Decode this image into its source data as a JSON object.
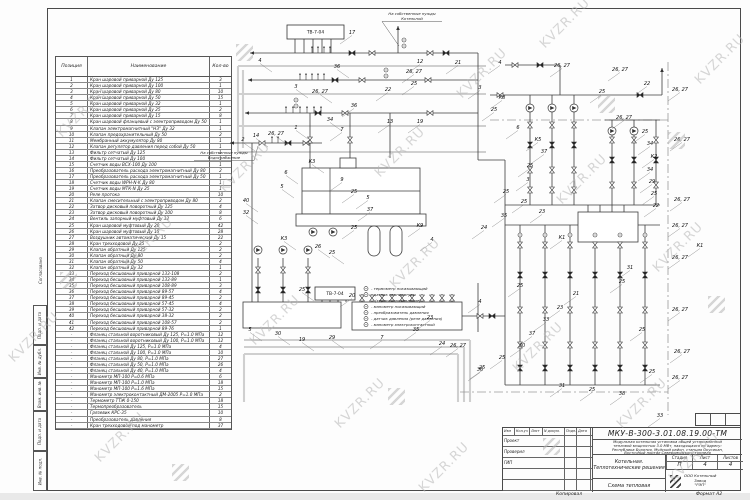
{
  "watermark": {
    "text": "KVZR.RU",
    "positions": [
      {
        "x": 50,
        "y": 105,
        "t": "text"
      },
      {
        "x": 2,
        "y": 330,
        "t": "text"
      },
      {
        "x": 116,
        "y": 235,
        "t": "text"
      },
      {
        "x": 88,
        "y": 430,
        "t": "text"
      },
      {
        "x": 213,
        "y": 160,
        "t": "text"
      },
      {
        "x": 243,
        "y": 313,
        "t": "text"
      },
      {
        "x": 368,
        "y": 145,
        "t": "text"
      },
      {
        "x": 328,
        "y": 396,
        "t": "text"
      },
      {
        "x": 450,
        "y": 66,
        "t": "text"
      },
      {
        "x": 533,
        "y": 16,
        "t": "text"
      },
      {
        "x": 550,
        "y": 172,
        "t": "text"
      },
      {
        "x": 506,
        "y": 340,
        "t": "text"
      },
      {
        "x": 646,
        "y": 240,
        "t": "text"
      },
      {
        "x": 610,
        "y": 396,
        "t": "text"
      },
      {
        "x": 688,
        "y": 52,
        "t": "text"
      },
      {
        "x": 662,
        "y": 450,
        "t": "text"
      },
      {
        "x": 412,
        "y": 460,
        "t": "text"
      },
      {
        "x": 383,
        "y": 256,
        "t": "text"
      },
      {
        "x": 236,
        "y": 44,
        "t": "logo"
      },
      {
        "x": 60,
        "y": 272,
        "t": "logo"
      },
      {
        "x": 598,
        "y": 96,
        "t": "logo"
      },
      {
        "x": 708,
        "y": 296,
        "t": "logo"
      },
      {
        "x": 543,
        "y": 438,
        "t": "logo"
      },
      {
        "x": 172,
        "y": 464,
        "t": "logo"
      },
      {
        "x": 388,
        "y": 388,
        "t": "logo"
      },
      {
        "x": 668,
        "y": 132,
        "t": "logo"
      }
    ]
  },
  "side_stamps": {
    "approval": "Согласовано",
    "cells": [
      "Подп. и дата",
      "Инв. № дубл.",
      "Взам. инв. №",
      "Подп. и дата",
      "Инв. № подл."
    ]
  },
  "spec_table": {
    "headers": {
      "position": "Позиция",
      "name": "Наименование",
      "qty": "Кол-во"
    },
    "rows": [
      [
        "1",
        "Кран шаровой приварной Ду 125",
        "3"
      ],
      [
        "2",
        "Кран шаровой приварной Ду 100",
        "1"
      ],
      [
        "3",
        "Кран шаровой приварной Ду 80",
        "10"
      ],
      [
        "4",
        "Кран шаровой приварной Ду 50",
        "15"
      ],
      [
        "5",
        "Кран шаровой приварной Ду 32",
        "1"
      ],
      [
        "6",
        "Кран шаровой приварной Ду 25",
        "2"
      ],
      [
        "7",
        "Кран шаровой приварной Ду 15",
        "8"
      ],
      [
        "8",
        "Кран шаровой фланцевый с электроприводом Ду 50",
        "1"
      ],
      [
        "9",
        "Клапан электромагнитный \"НЗ\" Ду 32",
        "1"
      ],
      [
        "10",
        "Клапан предохранительный Ду 50",
        "2"
      ],
      [
        "11",
        "Мембранный аккумулятор Ду 80",
        "1"
      ],
      [
        "12",
        "Клапан регулятор давления перед собой Ду 50",
        "1"
      ],
      [
        "13",
        "Фильтр сетчатый Ду 125",
        "1"
      ],
      [
        "14",
        "Фильтр сетчатый Ду 100",
        "1"
      ],
      [
        "15",
        "Счетчик воды ВСХ-100 Ду 100",
        "1"
      ],
      [
        "16",
        "Преобразователь расхода электромагнитный Ду 80",
        "2"
      ],
      [
        "17",
        "Преобразователь расхода электромагнитный Ду 50",
        "1"
      ],
      [
        "18",
        "Счетчик воды WPH-N-K Ду 80",
        "1"
      ],
      [
        "19",
        "Счетчик воды МТК-N Ду 25",
        "1"
      ],
      [
        "20",
        "Реле протока",
        "10"
      ],
      [
        "21",
        "Клапан смесительный с электроприводом Ду 80",
        "2"
      ],
      [
        "22",
        "Затвор дисковый поворотный Ду 125",
        "4"
      ],
      [
        "23",
        "Затвор дисковый поворотный Ду 100",
        "8"
      ],
      [
        "24",
        "Вентиль запорный муфтовый Ду 32",
        "6"
      ],
      [
        "25",
        "Кран шаровой муфтовый Ду 20",
        "42"
      ],
      [
        "26",
        "Кран шаровой муфтовый Ду 15",
        "28"
      ],
      [
        "27",
        "Воздушник автоматический Ду 15",
        "22"
      ],
      [
        "28",
        "Кран трехходовой Ду 25",
        "2"
      ],
      [
        "29",
        "Клапан обратный Ду 125",
        "2"
      ],
      [
        "30",
        "Клапан обратный Ду 80",
        "2"
      ],
      [
        "31",
        "Клапан обратный Ду 50",
        "4"
      ],
      [
        "32",
        "Клапан обратный Ду 32",
        "1"
      ],
      [
        "33",
        "Переход бесшовный приварной 133-108",
        "2"
      ],
      [
        "34",
        "Переход бесшовный приварной 133-89",
        "1"
      ],
      [
        "35",
        "Переход бесшовный приварной 108-89",
        "3"
      ],
      [
        "36",
        "Переход бесшовный приварной 89-57",
        "4"
      ],
      [
        "37",
        "Переход бесшовный приварной 89-45",
        "2"
      ],
      [
        "38",
        "Переход бесшовный приварной 57-45",
        "4"
      ],
      [
        "39",
        "Переход бесшовный приварной 57-32",
        "2"
      ],
      [
        "40",
        "Переход бесшовный приварной 38-32",
        "2"
      ],
      [
        "41",
        "Переход бесшовный приварной 108-57",
        "2"
      ],
      [
        "42",
        "Переход бесшовный приварной 89-76",
        "1"
      ],
      [
        "-",
        "Фланец стальной воротниковый Ду 125, Р=1.0 МПа",
        "12"
      ],
      [
        "-",
        "Фланец стальной воротниковый Ду 100, Р=1.0 МПа",
        "12"
      ],
      [
        "-",
        "Фланец стальной Ду 125, Р=1.0 МПа",
        "4"
      ],
      [
        "-",
        "Фланец стальной Ду 100, Р=1.0 МПа",
        "10"
      ],
      [
        "-",
        "Фланец стальной Ду 80, Р=1.0 МПа",
        "27"
      ],
      [
        "-",
        "Фланец стальной Ду 50, Р=1.0 МПа",
        "26"
      ],
      [
        "-",
        "Фланец стальной Ду 40, Р=1.0 МПа",
        "4"
      ],
      [
        "-",
        "Манометр МП-100 Р=0.6 МПа",
        "6"
      ],
      [
        "-",
        "Манометр МП-100 Р=1.0 МПа",
        "18"
      ],
      [
        "-",
        "Манометр МП-100 Р=1.6 МПа",
        "15"
      ],
      [
        "-",
        "Манометр электроконтактный ДМ-2005 Р=1.0 МПа",
        "2"
      ],
      [
        "-",
        "Термометр ТТЖ 0-150",
        "18"
      ],
      [
        "-",
        "Термопреобразователь",
        "15"
      ],
      [
        "-",
        "Грязевик КРС-35",
        "10"
      ],
      [
        "-",
        "Преобразователь давления",
        "8"
      ],
      [
        "-",
        "Кран трехходовой под манометр",
        "37"
      ]
    ]
  },
  "schematic": {
    "equipment_boxes": [
      {
        "x": 287,
        "y": 25,
        "w": 57,
        "h": 14,
        "label": "ТВ-7-04"
      },
      {
        "x": 315,
        "y": 287,
        "w": 40,
        "h": 13,
        "label": "ТВ-7-04"
      }
    ],
    "notes": [
      {
        "x": 412,
        "y": 11,
        "lines": [
          "На собственные нужды",
          "Котельной"
        ],
        "tx": 399,
        "ty": 46
      },
      {
        "x": 224,
        "y": 150,
        "lines": [
          "На собственные нужды",
          "Водоснабжение"
        ],
        "tx": 258,
        "ty": 146
      }
    ],
    "legend": {
      "x": 366,
      "y": 290,
      "items": [
        [
          "термометр показывающий",
          1
        ],
        [
          "датчик температуры",
          1
        ],
        [
          "(термосопротивление)",
          0
        ],
        [
          "манометр показывающий",
          1
        ],
        [
          "преобразователь давления",
          1
        ],
        [
          "датчик давления (реле давления)",
          1
        ],
        [
          "манометр электроконтактный",
          1
        ]
      ]
    },
    "labels": [
      [
        352,
        34,
        "17"
      ],
      [
        260,
        62,
        "4"
      ],
      [
        337,
        68,
        "36"
      ],
      [
        296,
        88,
        "3"
      ],
      [
        320,
        93,
        "26, 27"
      ],
      [
        388,
        91,
        "22"
      ],
      [
        414,
        85,
        "25"
      ],
      [
        420,
        63,
        "12"
      ],
      [
        414,
        73,
        "26, 27"
      ],
      [
        458,
        64,
        "21"
      ],
      [
        500,
        64,
        "4"
      ],
      [
        296,
        129,
        "1"
      ],
      [
        330,
        121,
        "34"
      ],
      [
        354,
        107,
        "36"
      ],
      [
        342,
        131,
        "7"
      ],
      [
        390,
        123,
        "13"
      ],
      [
        420,
        123,
        "19"
      ],
      [
        243,
        141,
        "2"
      ],
      [
        256,
        137,
        "14"
      ],
      [
        276,
        135,
        "26, 27"
      ],
      [
        312,
        163,
        "К3"
      ],
      [
        286,
        174,
        "6"
      ],
      [
        282,
        188,
        "5"
      ],
      [
        342,
        181,
        "9"
      ],
      [
        354,
        193,
        "25"
      ],
      [
        368,
        199,
        "5"
      ],
      [
        370,
        211,
        "37"
      ],
      [
        246,
        202,
        "40"
      ],
      [
        246,
        214,
        "32"
      ],
      [
        284,
        240,
        "К3"
      ],
      [
        318,
        248,
        "26"
      ],
      [
        332,
        254,
        "25"
      ],
      [
        354,
        229,
        "25"
      ],
      [
        420,
        227,
        "К9"
      ],
      [
        432,
        241,
        "4"
      ],
      [
        250,
        331,
        "5"
      ],
      [
        278,
        335,
        "30"
      ],
      [
        302,
        341,
        "19"
      ],
      [
        332,
        339,
        "29"
      ],
      [
        382,
        339,
        "7"
      ],
      [
        302,
        291,
        "25"
      ],
      [
        352,
        297,
        "20"
      ],
      [
        430,
        319,
        "23"
      ],
      [
        416,
        331,
        "35"
      ],
      [
        442,
        345,
        "24"
      ],
      [
        458,
        347,
        "26, 27"
      ],
      [
        482,
        369,
        "25"
      ],
      [
        502,
        99,
        "К8"
      ],
      [
        480,
        89,
        "3"
      ],
      [
        494,
        111,
        "25"
      ],
      [
        518,
        129,
        "6"
      ],
      [
        538,
        141,
        "К5"
      ],
      [
        544,
        153,
        "37"
      ],
      [
        530,
        167,
        "25"
      ],
      [
        528,
        181,
        "3"
      ],
      [
        562,
        67,
        "26, 27"
      ],
      [
        620,
        71,
        "26, 27"
      ],
      [
        647,
        85,
        "22"
      ],
      [
        602,
        93,
        "25"
      ],
      [
        624,
        119,
        "26, 27"
      ],
      [
        645,
        133,
        "25"
      ],
      [
        650,
        145,
        "34"
      ],
      [
        654,
        158,
        "К2"
      ],
      [
        650,
        171,
        "34"
      ],
      [
        652,
        183,
        "29"
      ],
      [
        654,
        195,
        "25"
      ],
      [
        656,
        207,
        "22"
      ],
      [
        506,
        193,
        "25"
      ],
      [
        524,
        203,
        "25"
      ],
      [
        542,
        213,
        "23"
      ],
      [
        504,
        217,
        "35"
      ],
      [
        484,
        229,
        "24"
      ],
      [
        562,
        239,
        "К1"
      ],
      [
        700,
        247,
        "К1"
      ],
      [
        680,
        91,
        "26, 27"
      ],
      [
        682,
        141,
        "26, 27"
      ],
      [
        682,
        201,
        "26, 27"
      ],
      [
        680,
        227,
        "26, 27"
      ],
      [
        680,
        259,
        "26, 27"
      ],
      [
        680,
        311,
        "26, 27"
      ],
      [
        682,
        353,
        "26, 27"
      ],
      [
        680,
        379,
        "26, 27"
      ],
      [
        630,
        269,
        "31"
      ],
      [
        622,
        283,
        "25"
      ],
      [
        576,
        295,
        "21"
      ],
      [
        560,
        309,
        "23"
      ],
      [
        546,
        321,
        "33"
      ],
      [
        532,
        335,
        "37"
      ],
      [
        642,
        331,
        "25"
      ],
      [
        652,
        373,
        "25"
      ],
      [
        622,
        395,
        "38"
      ],
      [
        592,
        391,
        "25"
      ],
      [
        562,
        387,
        "31"
      ],
      [
        522,
        347,
        "30"
      ],
      [
        502,
        359,
        "25"
      ],
      [
        480,
        303,
        "4"
      ],
      [
        520,
        287,
        "25"
      ],
      [
        480,
        371,
        "36"
      ],
      [
        660,
        417,
        "33"
      ]
    ]
  },
  "title_block": {
    "doc_number": "МКУ-В-300-3.01.08.19.00-ТМ",
    "description_lines": [
      "Модульная котельная установка общей установленной",
      "тепловой мощностью 3.0 МВт, находящаяся по адресу:",
      "Республика Бурятия, Муйский район, станция Окусикан,",
      "Восточный портал Северомуйского тоннеля"
    ],
    "header_cells": [
      "Изм",
      "Кол.уч",
      "Лист",
      "N докум.",
      "Подп.",
      "Дата"
    ],
    "roles": [
      "Проект",
      "Проверил",
      "ГИП"
    ],
    "object_lines": [
      "Котельная.",
      "Теплотехнические решения"
    ],
    "stage": {
      "label": "Стадия",
      "value": "П"
    },
    "sheet": {
      "label": "Лист",
      "value": "4"
    },
    "sheets": {
      "label": "Листов",
      "value": "4"
    },
    "drawing_name": "Схема тепловая",
    "company_lines": [
      "ООО Котельный",
      "Завод",
      "\"РЭП\""
    ]
  },
  "footer": {
    "copied": "Копировал",
    "format": "Формат А2"
  }
}
